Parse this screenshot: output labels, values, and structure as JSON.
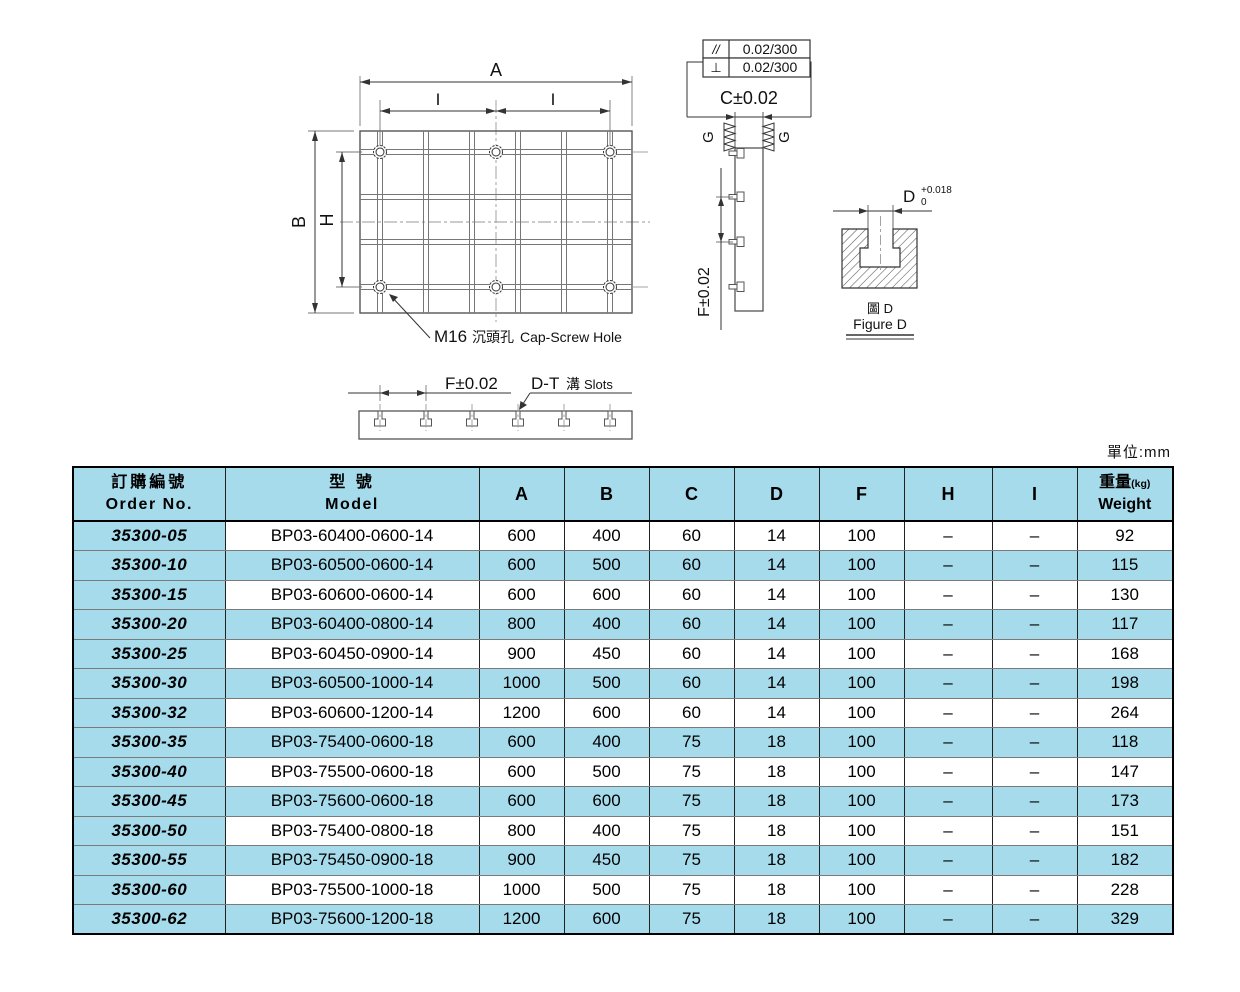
{
  "units_label": "單位:mm",
  "drawing": {
    "plan": {
      "dim_a": "A",
      "dim_i1": "I",
      "dim_i2": "I",
      "dim_b": "B",
      "dim_h": "H",
      "hole_note_m16": "M16",
      "hole_note_cjk": "沉頭孔",
      "hole_note_en": "Cap-Screw Hole"
    },
    "side": {
      "tol_parallel_sym": "//",
      "tol_parallel_val": "0.02/300",
      "tol_perp_sym": "⊥",
      "tol_perp_val": "0.02/300",
      "dim_c": "C±0.02",
      "finish_left": "G",
      "finish_right": "G",
      "dim_f": "F±0.02"
    },
    "figure_d": {
      "dim_d": "D",
      "tol_upper": "+0.018",
      "tol_lower": "0",
      "caption_cjk": "圖 D",
      "caption_en": "Figure D"
    },
    "section": {
      "dim_f": "F±0.02",
      "slots_d": "D-T",
      "slots_cjk": "溝",
      "slots_en": "Slots"
    }
  },
  "table": {
    "headers": {
      "order_cjk": "訂購編號",
      "order_en": "Order No.",
      "model_cjk": "型 號",
      "model_en": "Model",
      "dims": [
        "A",
        "B",
        "C",
        "D",
        "F",
        "H",
        "I"
      ],
      "weight_cjk": "重量",
      "weight_unit": "(kg)",
      "weight_en": "Weight"
    },
    "rows": [
      {
        "order": "35300-05",
        "model": "BP03-60400-0600-14",
        "a": "600",
        "b": "400",
        "c": "60",
        "d": "14",
        "f": "100",
        "h": "–",
        "i": "–",
        "weight": "92"
      },
      {
        "order": "35300-10",
        "model": "BP03-60500-0600-14",
        "a": "600",
        "b": "500",
        "c": "60",
        "d": "14",
        "f": "100",
        "h": "–",
        "i": "–",
        "weight": "115"
      },
      {
        "order": "35300-15",
        "model": "BP03-60600-0600-14",
        "a": "600",
        "b": "600",
        "c": "60",
        "d": "14",
        "f": "100",
        "h": "–",
        "i": "–",
        "weight": "130"
      },
      {
        "order": "35300-20",
        "model": "BP03-60400-0800-14",
        "a": "800",
        "b": "400",
        "c": "60",
        "d": "14",
        "f": "100",
        "h": "–",
        "i": "–",
        "weight": "117"
      },
      {
        "order": "35300-25",
        "model": "BP03-60450-0900-14",
        "a": "900",
        "b": "450",
        "c": "60",
        "d": "14",
        "f": "100",
        "h": "–",
        "i": "–",
        "weight": "168"
      },
      {
        "order": "35300-30",
        "model": "BP03-60500-1000-14",
        "a": "1000",
        "b": "500",
        "c": "60",
        "d": "14",
        "f": "100",
        "h": "–",
        "i": "–",
        "weight": "198"
      },
      {
        "order": "35300-32",
        "model": "BP03-60600-1200-14",
        "a": "1200",
        "b": "600",
        "c": "60",
        "d": "14",
        "f": "100",
        "h": "–",
        "i": "–",
        "weight": "264"
      },
      {
        "order": "35300-35",
        "model": "BP03-75400-0600-18",
        "a": "600",
        "b": "400",
        "c": "75",
        "d": "18",
        "f": "100",
        "h": "–",
        "i": "–",
        "weight": "118"
      },
      {
        "order": "35300-40",
        "model": "BP03-75500-0600-18",
        "a": "600",
        "b": "500",
        "c": "75",
        "d": "18",
        "f": "100",
        "h": "–",
        "i": "–",
        "weight": "147"
      },
      {
        "order": "35300-45",
        "model": "BP03-75600-0600-18",
        "a": "600",
        "b": "600",
        "c": "75",
        "d": "18",
        "f": "100",
        "h": "–",
        "i": "–",
        "weight": "173"
      },
      {
        "order": "35300-50",
        "model": "BP03-75400-0800-18",
        "a": "800",
        "b": "400",
        "c": "75",
        "d": "18",
        "f": "100",
        "h": "–",
        "i": "–",
        "weight": "151"
      },
      {
        "order": "35300-55",
        "model": "BP03-75450-0900-18",
        "a": "900",
        "b": "450",
        "c": "75",
        "d": "18",
        "f": "100",
        "h": "–",
        "i": "–",
        "weight": "182"
      },
      {
        "order": "35300-60",
        "model": "BP03-75500-1000-18",
        "a": "1000",
        "b": "500",
        "c": "75",
        "d": "18",
        "f": "100",
        "h": "–",
        "i": "–",
        "weight": "228"
      },
      {
        "order": "35300-62",
        "model": "BP03-75600-1200-18",
        "a": "1200",
        "b": "600",
        "c": "75",
        "d": "18",
        "f": "100",
        "h": "–",
        "i": "–",
        "weight": "329"
      }
    ]
  },
  "colors": {
    "highlight_blue": "#A6DBEC",
    "line_gray": "#555555",
    "dim_gray": "#777777",
    "text_black": "#111111"
  }
}
